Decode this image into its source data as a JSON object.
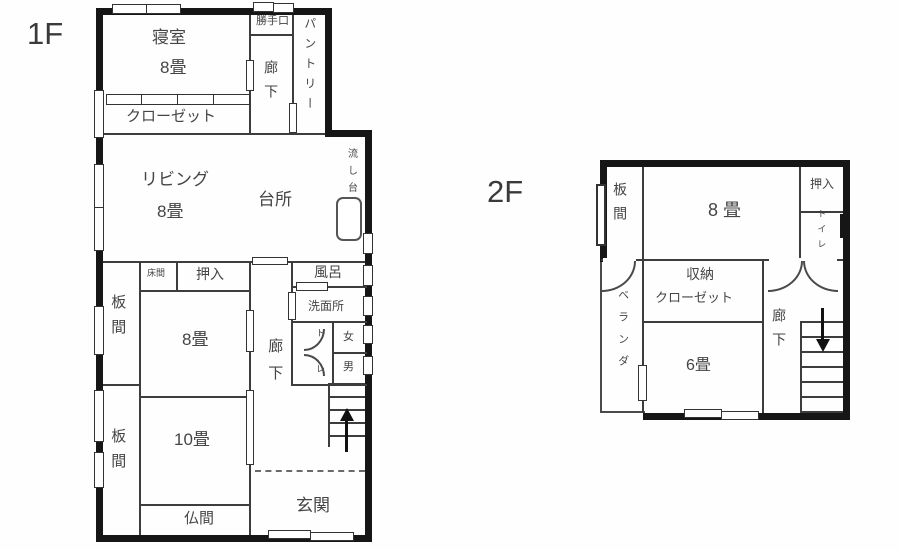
{
  "floor1": {
    "title": "1F",
    "labels": {
      "bedroom": "寝室",
      "bedroom_size": "8畳",
      "back_door": "勝手口",
      "hallway_top": "廊下",
      "pantry": "パントリー",
      "closet": "クローゼット",
      "living": "リビング",
      "living_size": "8畳",
      "kitchen": "台所",
      "sink": "流し台",
      "tokonoma": "床間",
      "oshiire": "押入",
      "itanoma_upper": "板間",
      "room8": "8畳",
      "hallway_lower": "廊下",
      "bath": "風呂",
      "washroom": "洗面所",
      "toilet_to": "ト",
      "toilet_re": "レ",
      "women": "女",
      "men": "男",
      "itanoma_lower": "板間",
      "room10": "10畳",
      "butsuma": "仏間",
      "entrance": "玄関"
    }
  },
  "floor2": {
    "title": "2F",
    "labels": {
      "itanoma": "板間",
      "room8": "8畳",
      "oshiire": "押入",
      "toilet": "トイレ",
      "storage": "収納",
      "storage_closet": "クローゼット",
      "veranda": "ベランダ",
      "room6": "6畳",
      "hallway": "廊下"
    }
  },
  "colors": {
    "wall": "#161616",
    "line": "#3d3d3d",
    "text": "#454545",
    "background": "#ffffff"
  }
}
